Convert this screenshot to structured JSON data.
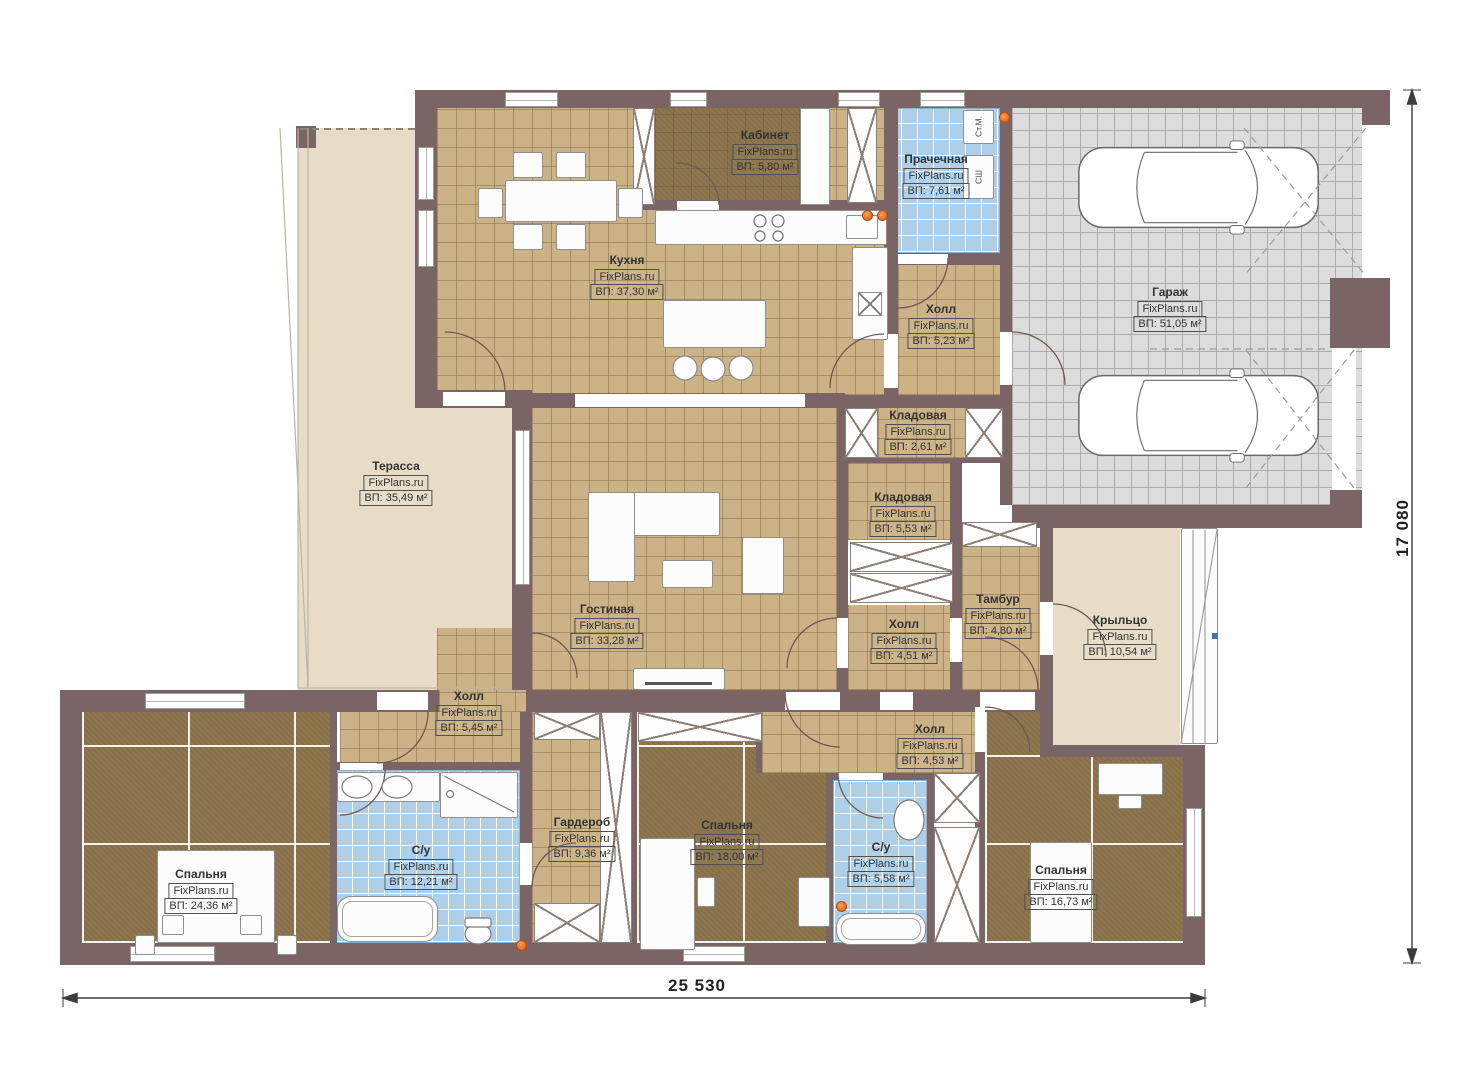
{
  "watermark": "FixPlans.ru",
  "dimensions": {
    "width_label": "25 530",
    "height_label": "17 080"
  },
  "appliances": {
    "washer": "Ст.М.",
    "dryer": "СШ"
  },
  "rooms": [
    {
      "id": "kabinet",
      "name": "Кабинет",
      "area": "ВП: 5,80 м²"
    },
    {
      "id": "prachechnaya",
      "name": "Прачечная",
      "area": "ВП: 7,61 м²"
    },
    {
      "id": "kuhnya",
      "name": "Кухня",
      "area": "ВП: 37,30 м²"
    },
    {
      "id": "holl523",
      "name": "Холл",
      "area": "ВП: 5,23 м²"
    },
    {
      "id": "garazh",
      "name": "Гараж",
      "area": "ВП: 51,05 м²"
    },
    {
      "id": "terassa",
      "name": "Терасса",
      "area": "ВП: 35,49 м²"
    },
    {
      "id": "kld261",
      "name": "Кладовая",
      "area": "ВП: 2,61 м²"
    },
    {
      "id": "kld553",
      "name": "Кладовая",
      "area": "ВП: 5,53 м²"
    },
    {
      "id": "gostinaya",
      "name": "Гостиная",
      "area": "ВП: 33,28 м²"
    },
    {
      "id": "holl451",
      "name": "Холл",
      "area": "ВП: 4,51 м²"
    },
    {
      "id": "tambur",
      "name": "Тамбур",
      "area": "ВП: 4,80 м²"
    },
    {
      "id": "krylco",
      "name": "Крыльцо",
      "area": "ВП: 10,54 м²"
    },
    {
      "id": "holl545",
      "name": "Холл",
      "area": "ВП: 5,45 м²"
    },
    {
      "id": "holl453",
      "name": "Холл",
      "area": "ВП: 4,53 м²"
    },
    {
      "id": "sp2436",
      "name": "Спальня",
      "area": "ВП: 24,36 м²"
    },
    {
      "id": "su1221",
      "name": "С/у",
      "area": "ВП: 12,21 м²"
    },
    {
      "id": "garderob",
      "name": "Гардероб",
      "area": "ВП: 9,36 м²"
    },
    {
      "id": "sp1800",
      "name": "Спальня",
      "area": "ВП: 18,00 м²"
    },
    {
      "id": "su558",
      "name": "С/у",
      "area": "ВП: 5,58 м²"
    },
    {
      "id": "sp1673",
      "name": "Спальня",
      "area": "ВП: 16,73 м²"
    }
  ]
}
